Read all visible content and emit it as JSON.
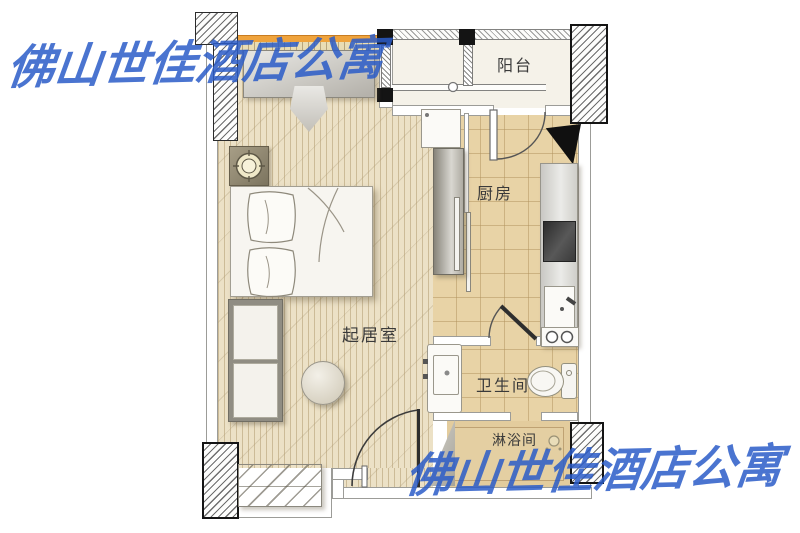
{
  "plan_type": "apartment-floor-plan",
  "watermark": {
    "text": "佛山世佳酒店公寓",
    "color": "#2b5cc8",
    "positions": [
      "top-left",
      "bottom-right"
    ]
  },
  "rooms": {
    "balcony": {
      "label": "阳台"
    },
    "kitchen": {
      "label": "厨房"
    },
    "living_room": {
      "label": "起居室"
    },
    "bathroom": {
      "label": "卫生间"
    },
    "shower_room": {
      "label": "淋浴间"
    }
  },
  "palette": {
    "floor_living": "#ece1c6",
    "floor_kitchen": "#e8d3a6",
    "floor_balcony": "#f5f2e9",
    "floor_shower": "#e3cc9d",
    "window_accent_orange": "#efa33c",
    "wall_outline": "#9c9c98",
    "hatch_wall_border": "#141414",
    "furniture_gray": "#b5b2ab",
    "stove_dark": "#2c2c2c",
    "watermark_blue": "#2b5cc8"
  }
}
